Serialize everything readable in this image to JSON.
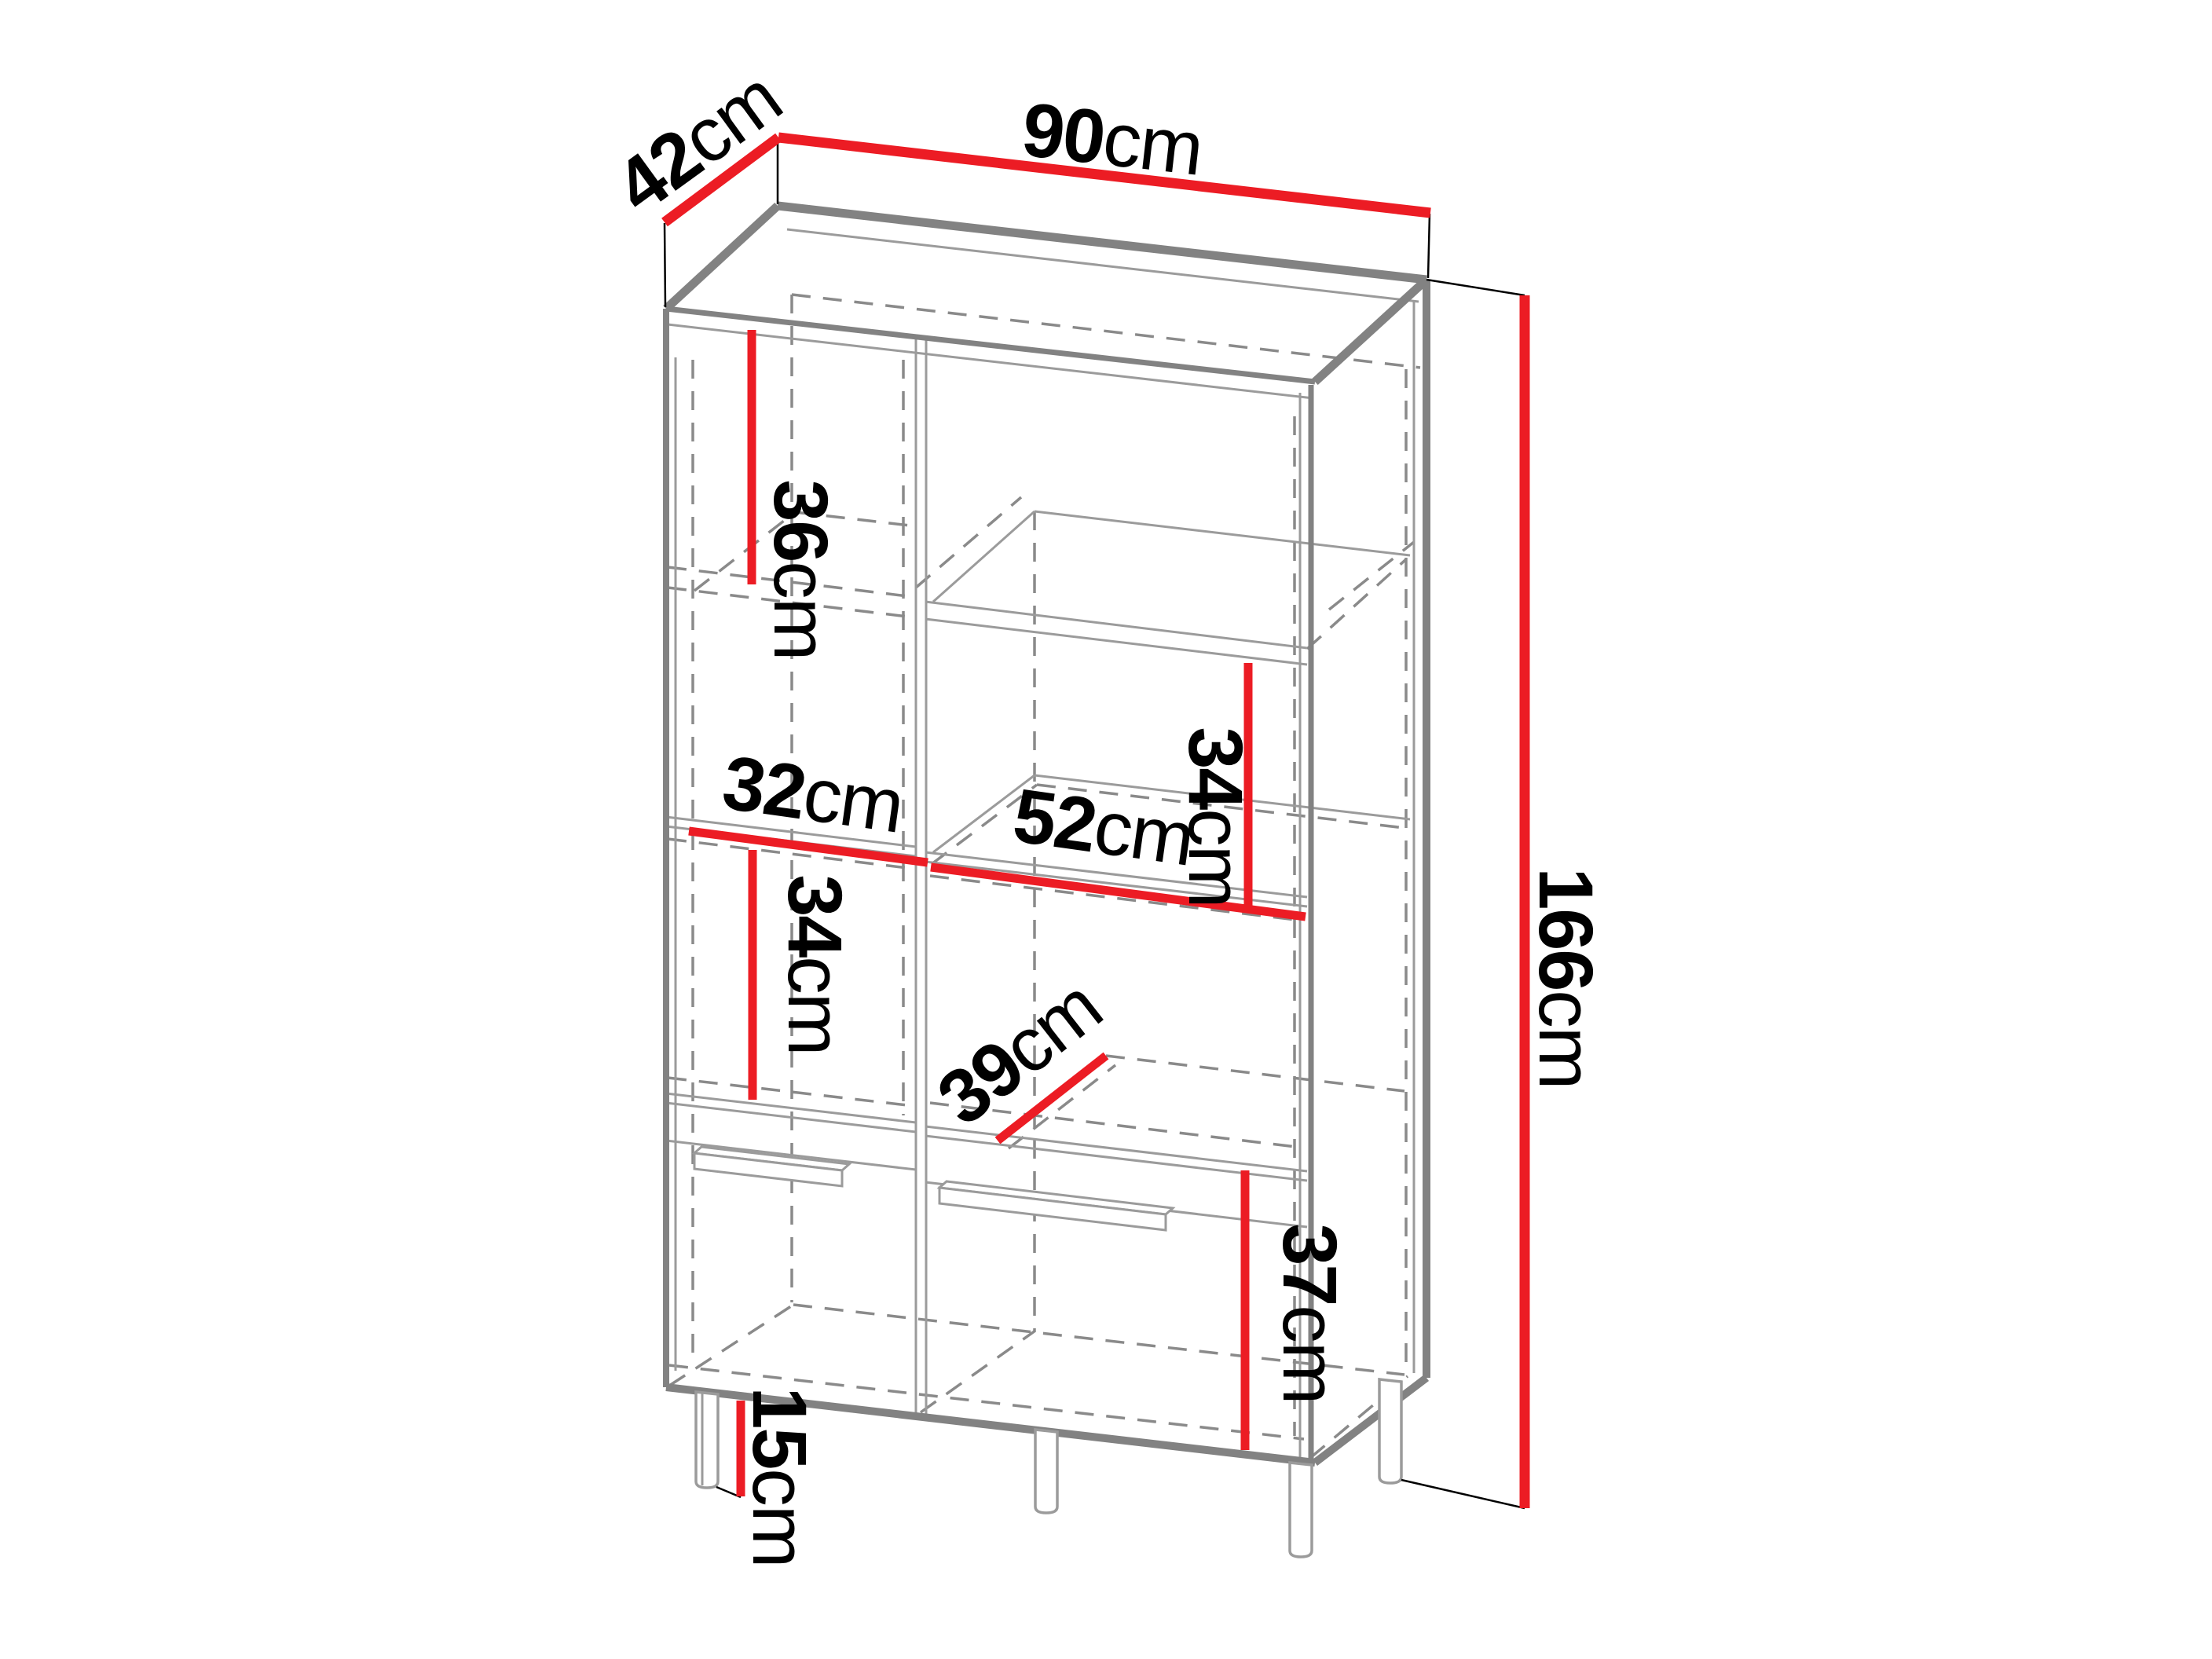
{
  "diagram": {
    "type": "furniture-dimension-drawing",
    "subject": "two-door display cabinet wireframe with legs",
    "unit": "cm",
    "accent_color": "#ec1c24",
    "line_color_thick": "#828282",
    "line_color_thin": "#9b9b9b",
    "line_color_dash": "#8a8a8a",
    "text_color": "#000000",
    "dimensions": {
      "top_depth": {
        "num": "42",
        "unit": "cm"
      },
      "top_width": {
        "num": "90",
        "unit": "cm"
      },
      "total_height": {
        "num": "166",
        "unit": "cm"
      },
      "upper_left_shelf": {
        "num": "36",
        "unit": "cm"
      },
      "left_inner_width": {
        "num": "32",
        "unit": "cm"
      },
      "right_inner_width": {
        "num": "52",
        "unit": "cm"
      },
      "right_shelf_height": {
        "num": "34",
        "unit": "cm"
      },
      "left_shelf_height": {
        "num": "34",
        "unit": "cm"
      },
      "shelf_depth": {
        "num": "39",
        "unit": "cm"
      },
      "bottom_door_height": {
        "num": "37",
        "unit": "cm"
      },
      "leg_height": {
        "num": "15",
        "unit": "cm"
      }
    }
  }
}
